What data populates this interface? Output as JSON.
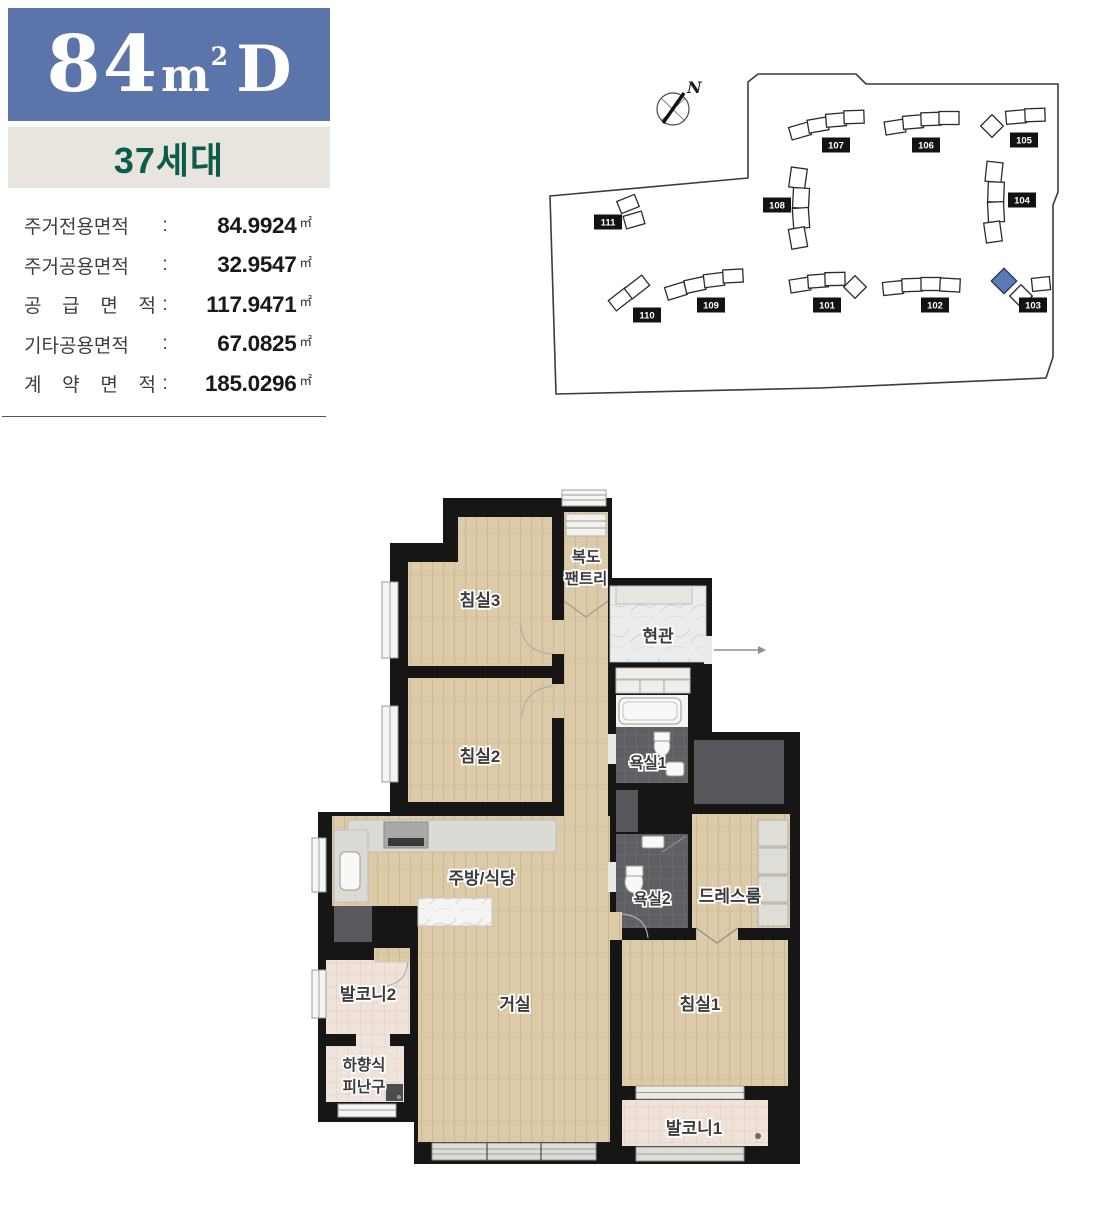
{
  "header": {
    "size_number": "84",
    "size_unit": "m",
    "size_sup": "2",
    "size_type": "D",
    "households": "37세대"
  },
  "areas": {
    "unit": "㎡",
    "rows": [
      {
        "label": "주거전용면적",
        "value": "84.9924"
      },
      {
        "label": "주거공용면적",
        "value": "32.9547"
      },
      {
        "label": "공 급 면 적",
        "value": "117.9471"
      },
      {
        "label": "기타공용면적",
        "value": "67.0825"
      },
      {
        "label": "계 약 면 적",
        "value": "185.0296"
      }
    ]
  },
  "site_plan": {
    "compass": "N",
    "highlight_color": "#5b79b4",
    "buildings": [
      {
        "id": "101"
      },
      {
        "id": "102"
      },
      {
        "id": "103"
      },
      {
        "id": "104"
      },
      {
        "id": "105"
      },
      {
        "id": "106"
      },
      {
        "id": "107"
      },
      {
        "id": "108"
      },
      {
        "id": "109"
      },
      {
        "id": "110"
      },
      {
        "id": "111"
      }
    ]
  },
  "floor_plan": {
    "rooms": {
      "bedroom3": "침실3",
      "pantry_line1": "복도",
      "pantry_line2": "팬트리",
      "entrance": "현관",
      "bedroom2": "침실2",
      "bath1": "욕실1",
      "kitchen_dining": "주방/식당",
      "bath2": "욕실2",
      "dressroom": "드레스룸",
      "living": "거실",
      "bedroom1": "침실1",
      "balcony1": "발코니1",
      "balcony2": "발코니2",
      "hatch_line1": "하향식",
      "hatch_line2": "피난구"
    }
  },
  "colors": {
    "title_bg": "#5b74a9",
    "badge_bg": "#e8e5df",
    "badge_text": "#0d5c49",
    "wall": "#161616",
    "wood": "#ddcaa8"
  }
}
